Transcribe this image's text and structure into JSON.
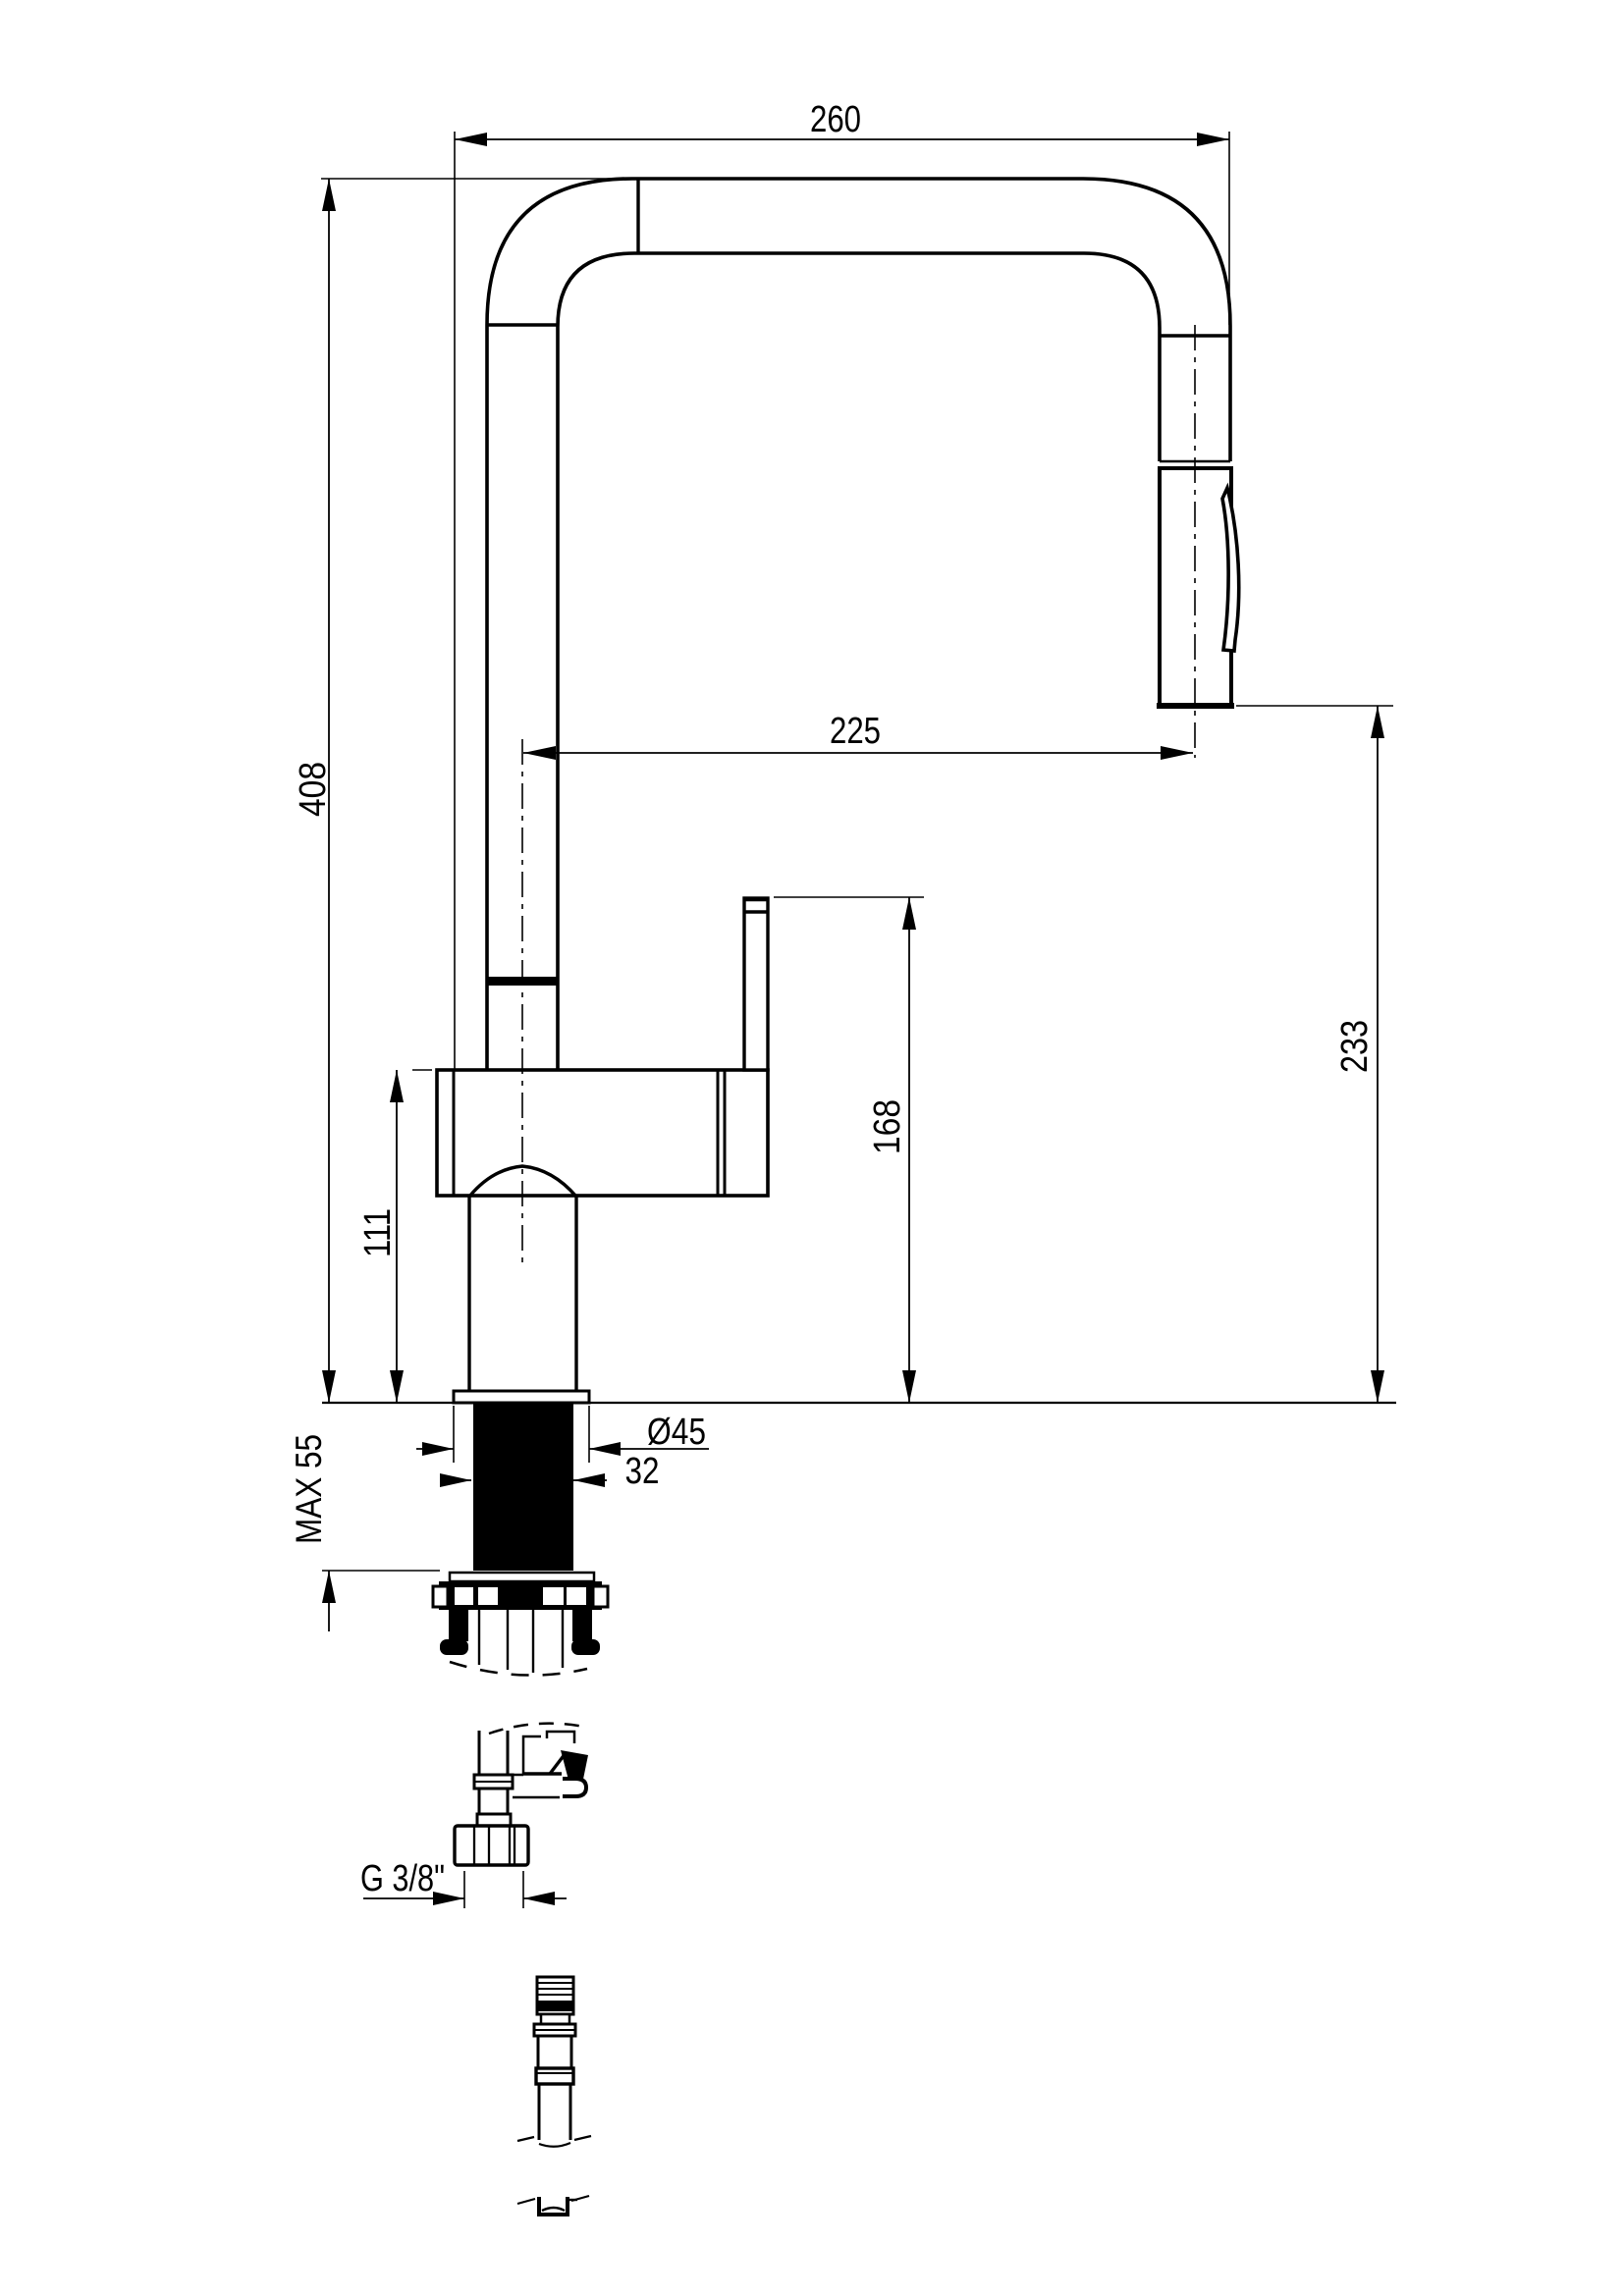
{
  "page": {
    "background": "#ffffff",
    "line_color": "#000000",
    "type": "technical-dimension-drawing",
    "subject": "kitchen faucet with pull-out spray, side view with under-counter mounting parts"
  },
  "labels": {
    "dim_total_width": "260",
    "dim_spout_reach": "225",
    "dim_total_height": "408",
    "dim_head_to_counter": "233",
    "dim_handle_height": "168",
    "dim_body_height": "111",
    "dim_max_mounting": "MAX 55",
    "dim_base_diameter": "Ø45",
    "dim_shank_width": "32",
    "dim_thread_size": "G 3/8\""
  }
}
